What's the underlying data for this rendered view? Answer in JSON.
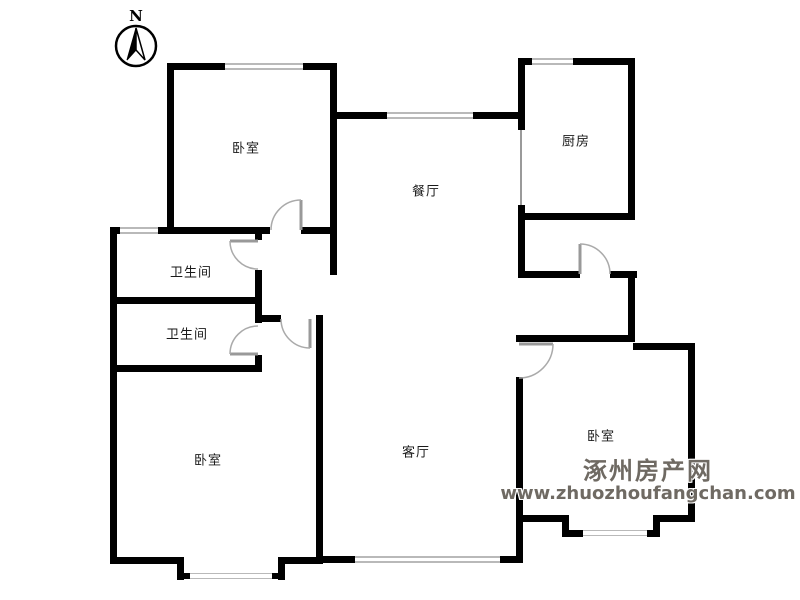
{
  "compass": {
    "label": "N",
    "icon": "north-arrow"
  },
  "rooms": [
    {
      "id": "bedroom-nw",
      "label": "卧室"
    },
    {
      "id": "dining",
      "label": "餐厅"
    },
    {
      "id": "kitchen",
      "label": "厨房"
    },
    {
      "id": "bath-north",
      "label": "卫生间"
    },
    {
      "id": "bath-south",
      "label": "卫生间"
    },
    {
      "id": "bedroom-sw",
      "label": "卧室"
    },
    {
      "id": "living",
      "label": "客厅"
    },
    {
      "id": "bedroom-east",
      "label": "卧室"
    }
  ],
  "watermark": {
    "site_name": "涿州房产网",
    "site_url": "www.zhuozhoufangchan.com"
  },
  "colors": {
    "wall": "#000000",
    "window": "#b9b9b9",
    "door_arc": "#aaaaaa",
    "watermark_text": "#6f6a63"
  }
}
